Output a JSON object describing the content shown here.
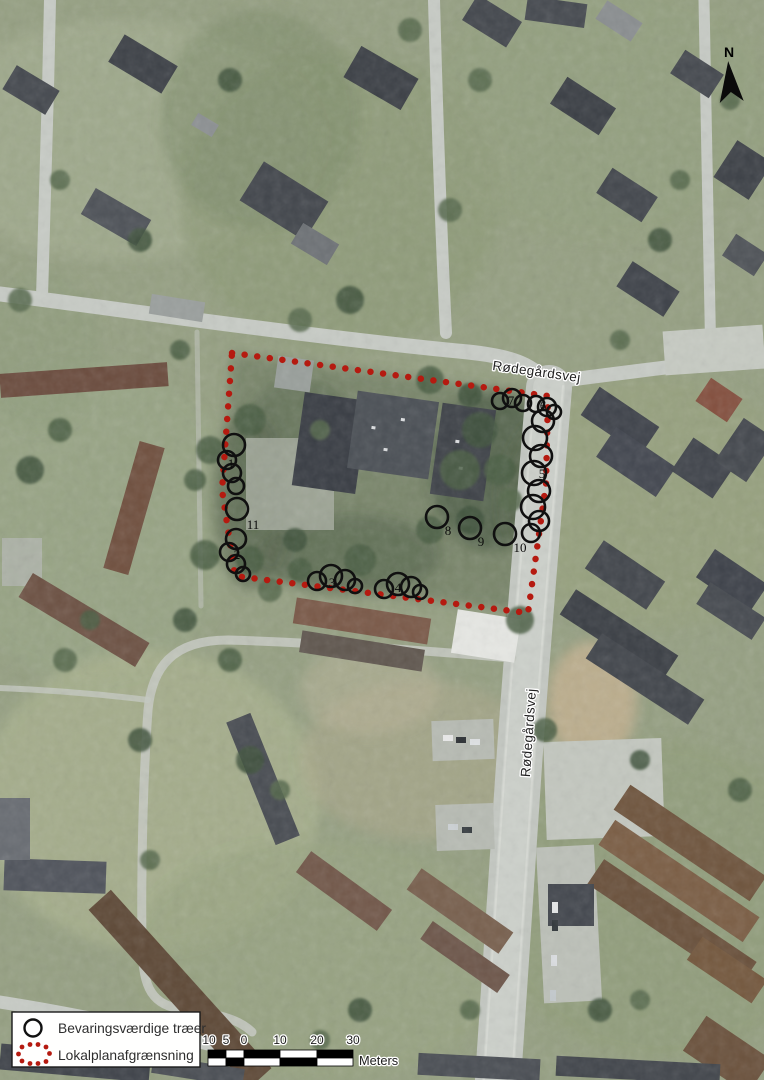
{
  "map_figure": {
    "north_arrow_label": "N",
    "street_labels": {
      "top": "Rødegårdsvej",
      "side": "Rødegårdsvej"
    },
    "tree_markers": [
      {
        "label": "1"
      },
      {
        "label": "2"
      },
      {
        "label": "3"
      },
      {
        "label": "4"
      },
      {
        "label": "5"
      },
      {
        "label": "6"
      },
      {
        "label": "7"
      },
      {
        "label": "8"
      },
      {
        "label": "9"
      },
      {
        "label": "10"
      },
      {
        "label": "11"
      }
    ]
  },
  "legend": {
    "items": [
      {
        "symbol": "tree-circle",
        "label": "Bevaringsværdige træer"
      },
      {
        "symbol": "boundary-dots",
        "label": "Lokalplanafgrænsning"
      }
    ]
  },
  "scale_bar": {
    "tick_labels": [
      "10",
      "5",
      "0",
      "10",
      "20",
      "30"
    ],
    "unit_label": "Meters"
  },
  "colors": {
    "boundary_red": "#b51a10",
    "tree_outline": "#101010"
  }
}
